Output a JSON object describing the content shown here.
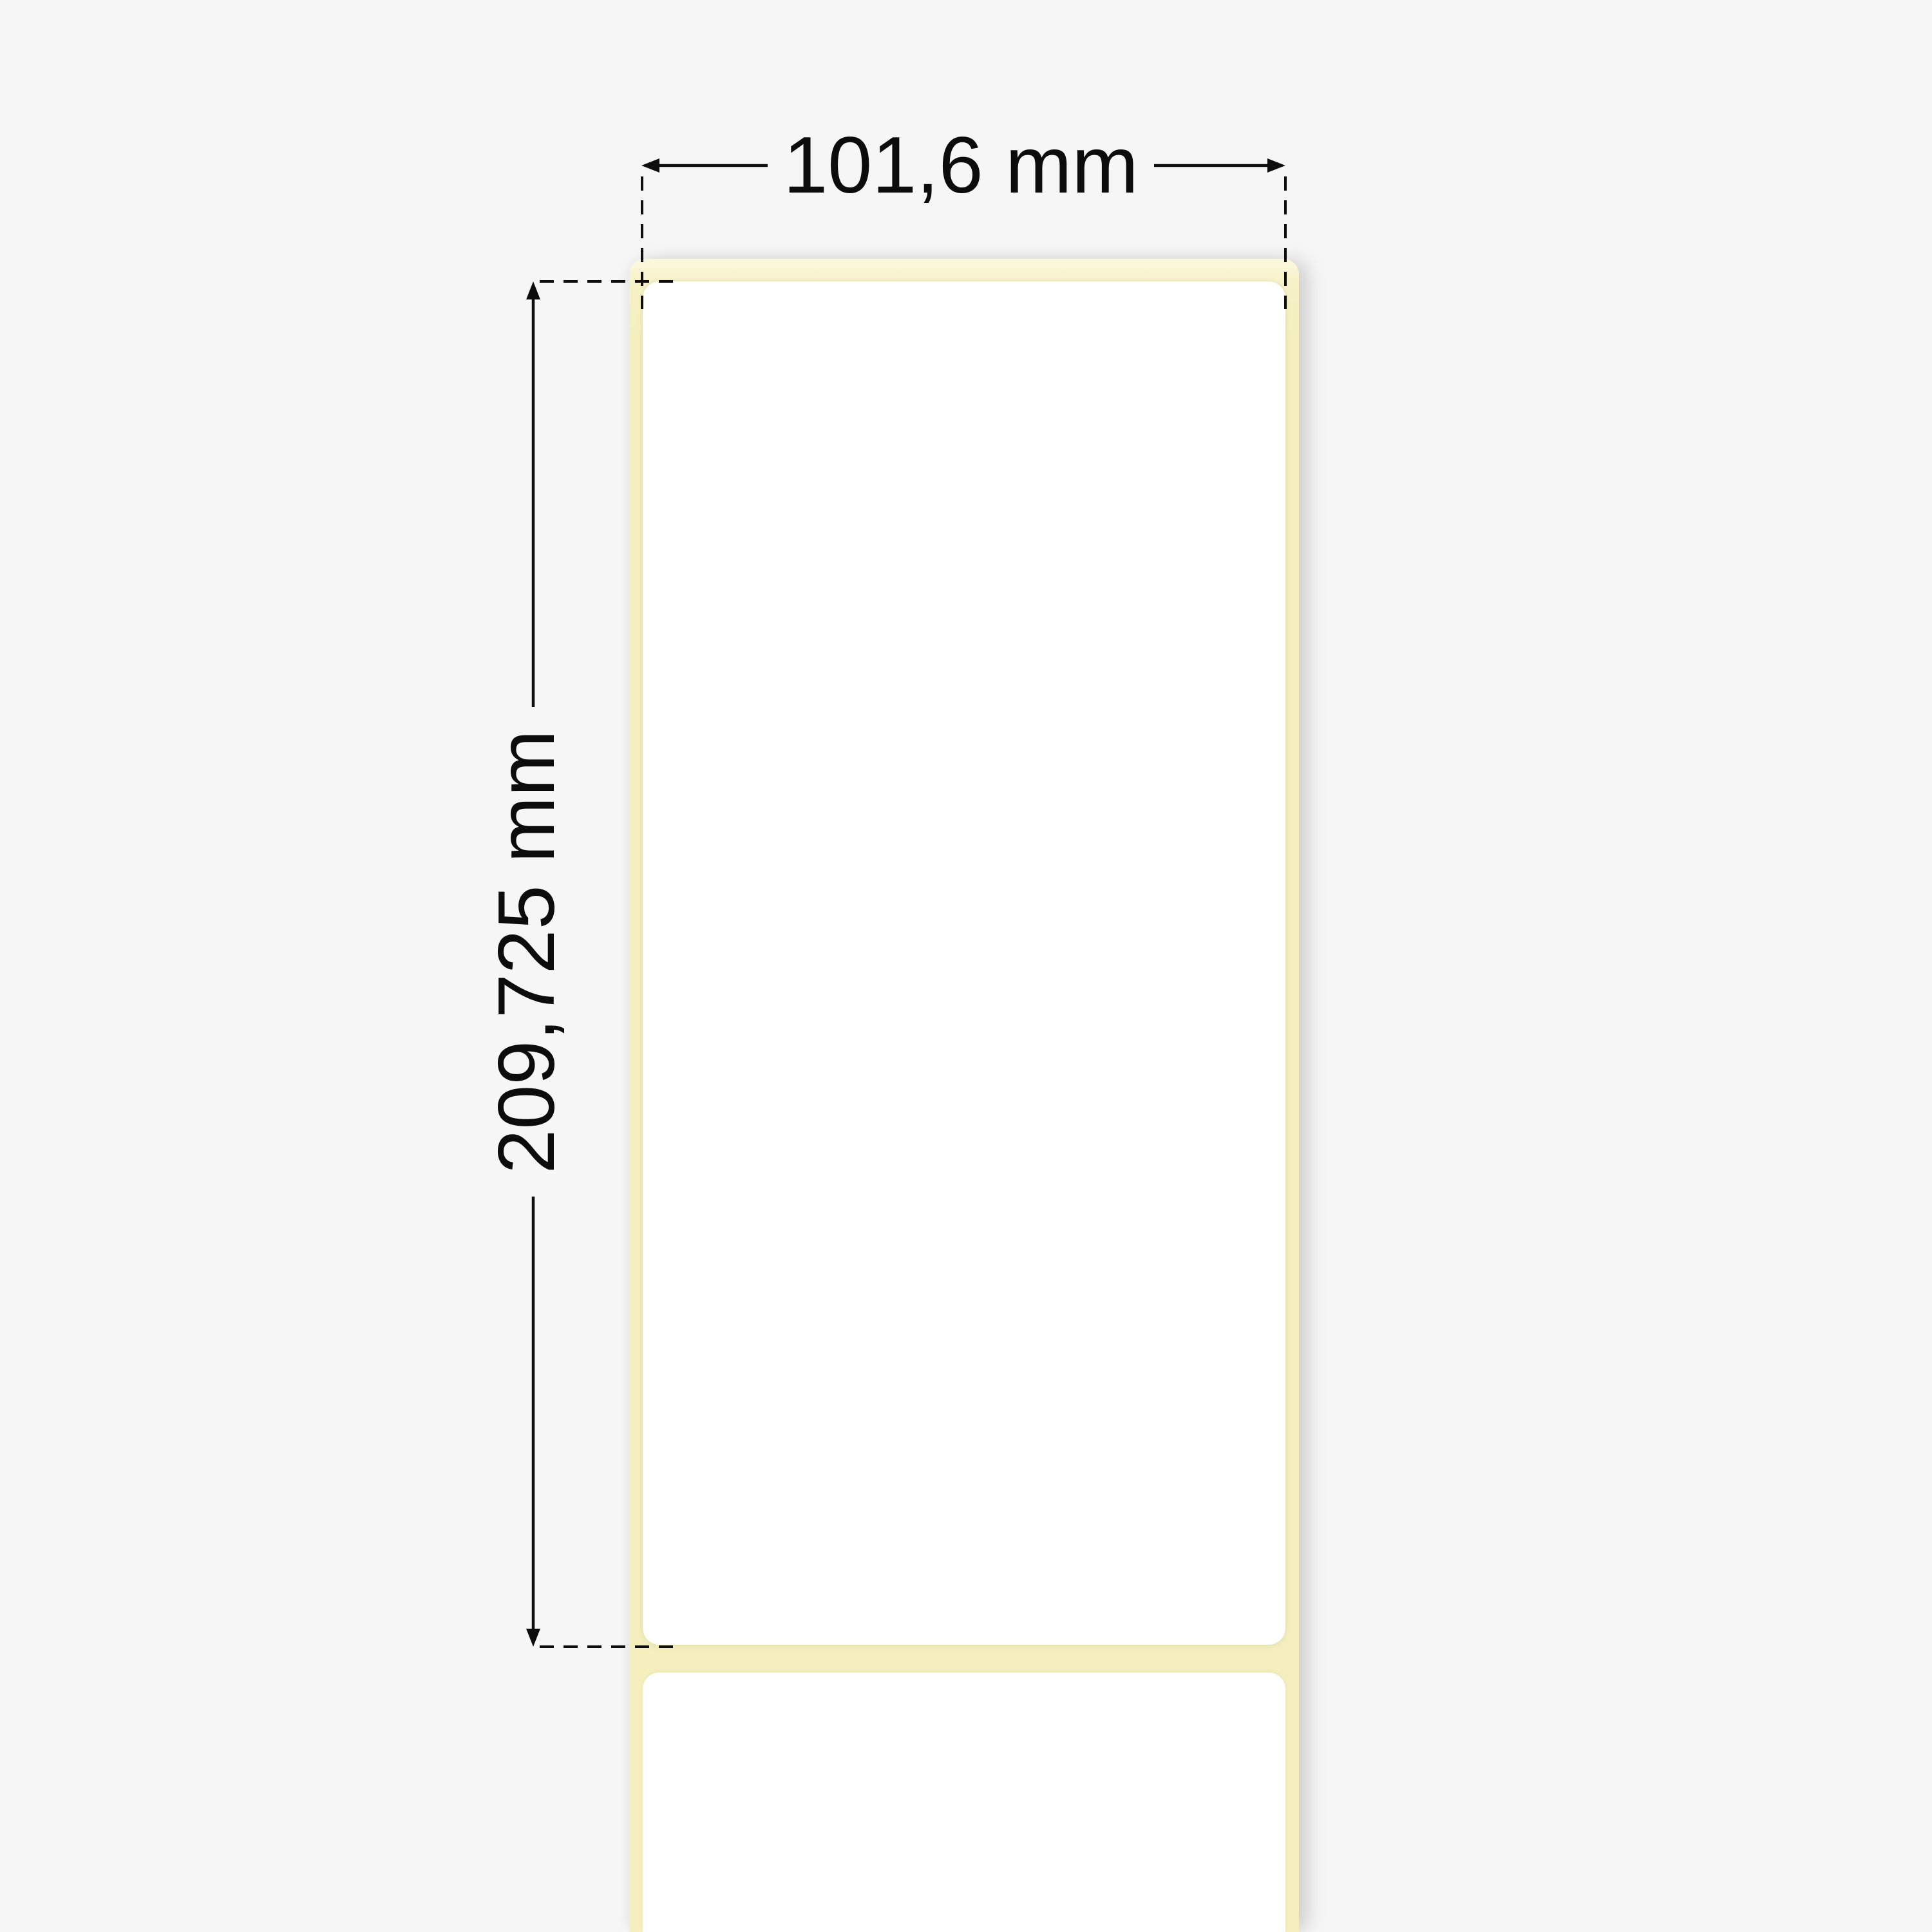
{
  "dimensions": {
    "width_label": "101,6 mm",
    "height_label": "209,725 mm"
  },
  "colors": {
    "background": "#f6f6f6",
    "liner_yellow": "#f4efbd",
    "label_white": "#ffffff",
    "annotation_black": "#0d0d0d"
  },
  "diagram": {
    "liner_name": "adhesive label liner strip",
    "labels_visible": 2
  }
}
